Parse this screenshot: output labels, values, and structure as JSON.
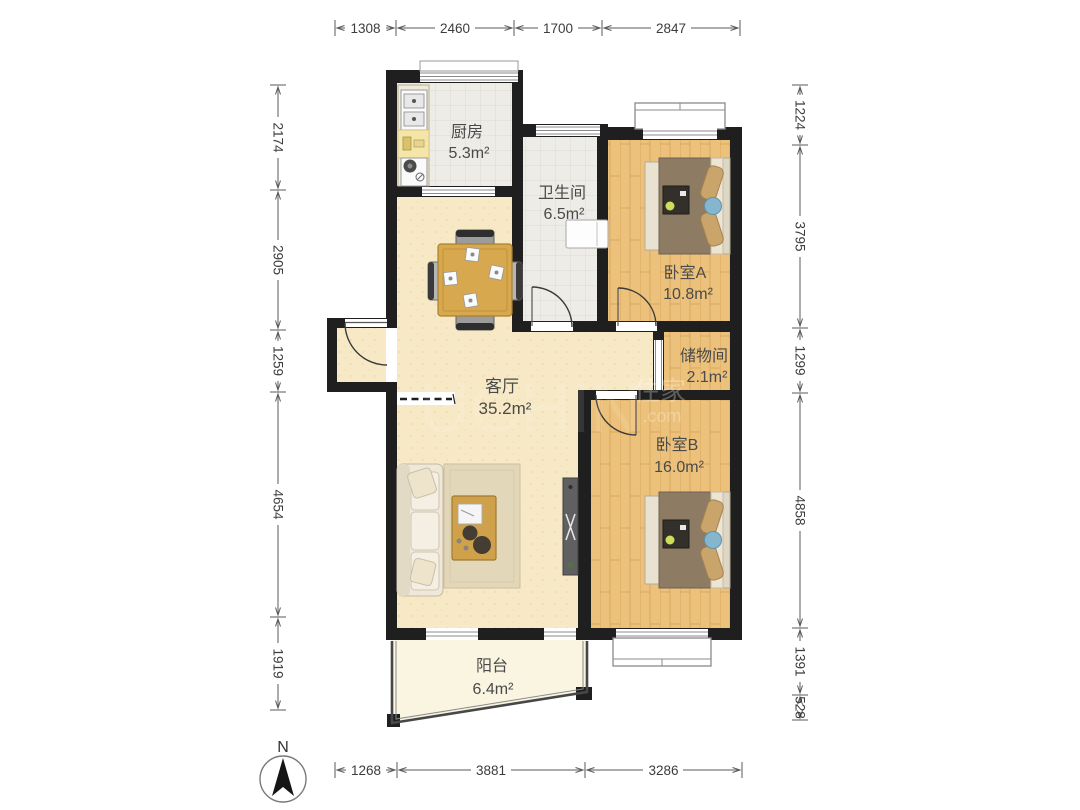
{
  "rooms": {
    "kitchen": {
      "name": "厨房",
      "area": "5.3m²"
    },
    "bathroom": {
      "name": "卫生间",
      "area": "6.5m²"
    },
    "bedroom_a": {
      "name": "卧室A",
      "area": "10.8m²"
    },
    "storage": {
      "name": "储物间",
      "area": "2.1m²"
    },
    "living": {
      "name": "客厅",
      "area": "35.2m²"
    },
    "bedroom_b": {
      "name": "卧室B",
      "area": "16.0m²"
    },
    "balcony": {
      "name": "阳台",
      "area": "6.4m²"
    }
  },
  "dimensions": {
    "top": [
      "1308",
      "2460",
      "1700",
      "2847"
    ],
    "left": [
      "2174",
      "2905",
      "1259",
      "4654",
      "1919"
    ],
    "right": [
      "1224",
      "3795",
      "1299",
      "4858",
      "1391",
      "528"
    ],
    "bottom": [
      "1268",
      "3881",
      "3286"
    ]
  },
  "compass": {
    "label": "N"
  },
  "watermark": {
    "ghost": "UCHIN",
    "cjk": "住家",
    "domain": ".com"
  },
  "colors": {
    "wall": "#1f1f1f",
    "wood_floor": "#ecc17c",
    "living_floor": "#f7e9c6",
    "tile_floor": "#eeece7",
    "balcony_floor": "#f9f5e1",
    "duvet": "#8d7b64",
    "pillow": "#c9a56b",
    "table_wood": "#d8a84e"
  }
}
